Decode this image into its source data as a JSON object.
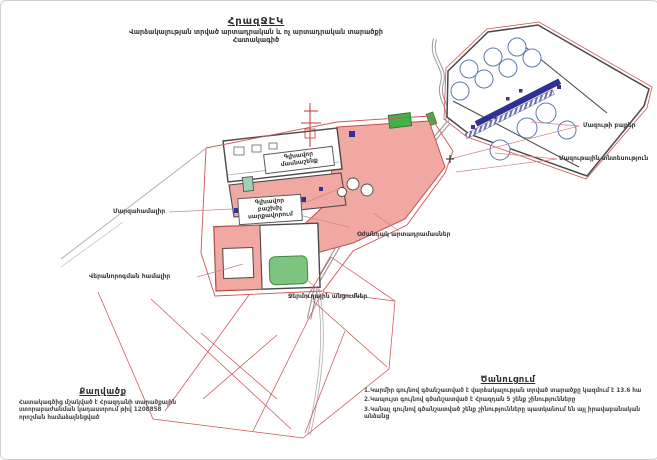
{
  "page": {
    "title": "ՀրազՋԷԿ",
    "subtitle_line1": "Վարձակալության տրված արտադրական և ոչ արտադրական տարածքի",
    "subtitle_line2": "Հատակագիծ"
  },
  "map": {
    "labels": {
      "mazut_tanks": "Մազութի բաքեր",
      "mazut_facility": "Մազութային տնտեսություն",
      "sports_complex": "Մարզահամալիր",
      "repair_complex": "Վերանորոգման համալիր",
      "aux_workshops": "Օժանդակ արտադրամասներ",
      "thermal_lines": "Ջերմուղային անցումներ",
      "main_building_line1": "Գլխավոր",
      "main_building_line2": "մասնաշենք",
      "switchgear_line1": "Գլխավոր",
      "switchgear_line2": "բաշխիչ",
      "switchgear_line3": "սարքավորում"
    }
  },
  "extract": {
    "title": "Քաղվածք",
    "line1": "Հատակագծից մշակված է Հրազդանի տարածքային",
    "line2": "ստորաբաժանման կադաստրում թիվ 1208858",
    "line3": "որոշման համաձայնեցված"
  },
  "notice": {
    "title": "Ծանուցում",
    "items": [
      "1.Կարմիր գույնով գծանշատված է վարձակալության տրված տարածքը կազմում է 13.6 հա",
      "2.Կապույտ գույնով գծանշատված է Հրազդան 5 շենք շինությունները",
      "3.Կանաչ գույնով գծանշատված շենք շինությունները պատկանում են այլ իրավաբանական անձանց"
    ]
  },
  "colors": {
    "leased_fill": "#f2a8a2",
    "boundary_red": "#cc5555",
    "outline_dark": "#4a4a4a",
    "rack_navy": "#2e3192",
    "green_area": "#44b04a"
  }
}
